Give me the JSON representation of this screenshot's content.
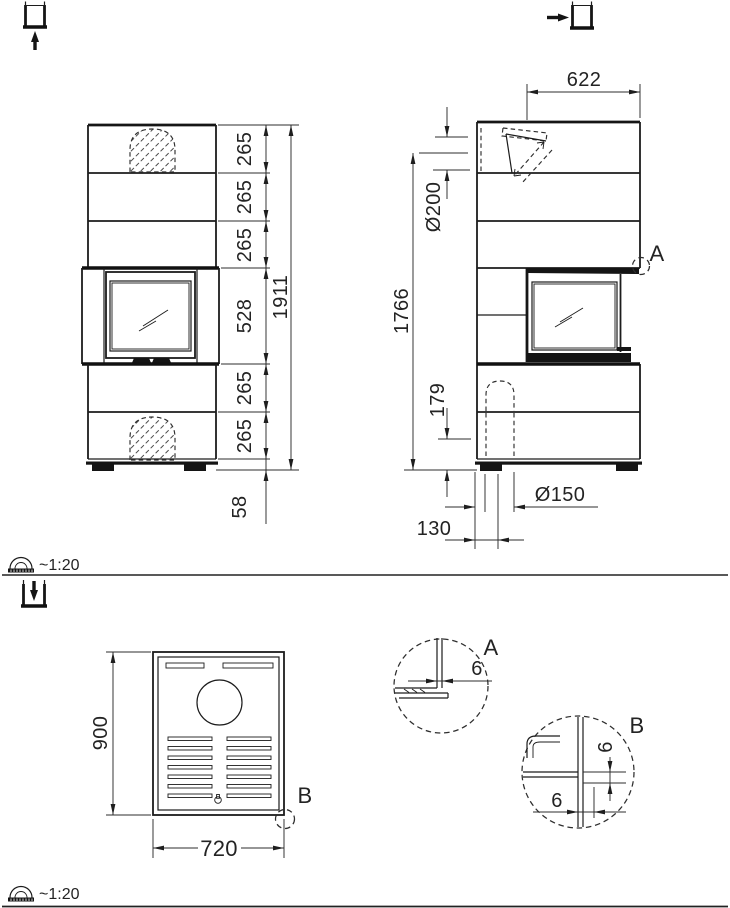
{
  "front_view": {
    "segments": [
      "265",
      "265",
      "265",
      "528",
      "265",
      "265"
    ],
    "overall_height": "1911",
    "plinth_height": "58"
  },
  "side_view": {
    "flue_outlet_offset": "622",
    "flue_diameter": "Ø200",
    "flue_center_height": "1766",
    "air_inlet_center_height": "179",
    "air_inlet_diameter": "Ø150",
    "air_inlet_offset": "130",
    "detail_marker": "A"
  },
  "top_view": {
    "depth": "900",
    "width": "720",
    "detail_marker": "B"
  },
  "details": {
    "a": {
      "label": "A",
      "gap": "6"
    },
    "b": {
      "label": "B",
      "gap_vertical": "6",
      "gap_horizontal": "6"
    }
  },
  "scale_indicators": {
    "upper": "~1:20",
    "lower": "~1:20"
  },
  "icons": {
    "front_view": "arrow-up-into-box",
    "side_view": "arrow-right-into-box",
    "top_view": "arrow-down-into-box",
    "scale": "protractor-ruler"
  },
  "colors": {
    "line": "#1c1c1c",
    "dimension": "#2d2d2d",
    "background": "#ffffff"
  }
}
